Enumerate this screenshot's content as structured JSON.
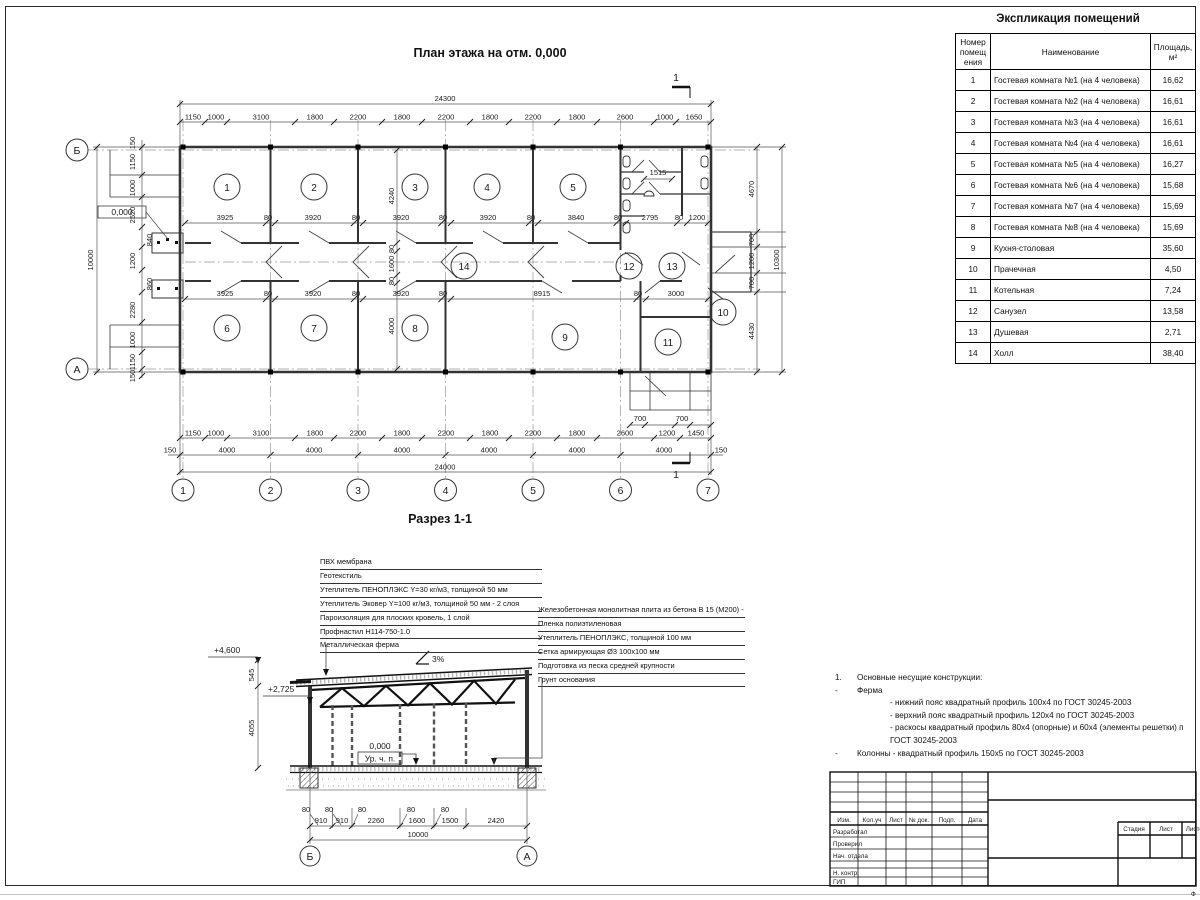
{
  "plan": {
    "title": "План этажа на отм. 0,000",
    "level_mark": "0,000",
    "section_cut_label": "1",
    "dim_total_top": "24300",
    "dims_top": [
      "1150",
      "1000",
      "3100",
      "1800",
      "2200",
      "1800",
      "2200",
      "1800",
      "2200",
      "1800",
      "2600",
      "1000",
      "1650"
    ],
    "dims_row_upper": [
      "3925",
      "80",
      "3920",
      "80",
      "3920",
      "80",
      "3920",
      "80",
      "3840",
      "80",
      "2795",
      "80",
      "1200"
    ],
    "dims_row_lower": [
      "3925",
      "80",
      "3920",
      "80",
      "3920",
      "80",
      "8915",
      "80",
      "3000"
    ],
    "dims_vchain": [
      "4240",
      "80",
      "1600",
      "80",
      "4000"
    ],
    "dim_san": "1515",
    "dims_right": [
      "4670",
      "700",
      "1200",
      "700",
      "4430"
    ],
    "dim_total_right": "10300",
    "dims_left": [
      "150",
      "1150",
      "1000",
      "2520",
      "840",
      "1200",
      "860",
      "2280",
      "1000",
      "1150",
      "150"
    ],
    "dim_total_left": "10000",
    "dims_bottom": [
      "1150",
      "1000",
      "3100",
      "1800",
      "2200",
      "1800",
      "2200",
      "1800",
      "2200",
      "1800",
      "2600",
      "1200",
      "1450"
    ],
    "dims_grid": [
      "150",
      "4000",
      "4000",
      "4000",
      "4000",
      "4000",
      "4000",
      "150"
    ],
    "dim_total_bottom": "24000",
    "dims_porch": [
      "700",
      "700"
    ],
    "grid_cols": [
      "1",
      "2",
      "3",
      "4",
      "5",
      "6",
      "7"
    ],
    "grid_row_top": "Б",
    "grid_row_bottom": "А",
    "rooms": [
      "1",
      "2",
      "3",
      "4",
      "5",
      "6",
      "7",
      "8",
      "9",
      "10",
      "11",
      "12",
      "13",
      "14"
    ]
  },
  "section": {
    "title": "Разрез 1-1",
    "slope_label": "3%",
    "level_top": "+4,600",
    "level_truss": "+2,725",
    "level_floor": "0,000",
    "floor_caption": "Ур. ч. п.",
    "dims_left": [
      "545",
      "4055"
    ],
    "dims_col": [
      "80",
      "80",
      "80",
      "80",
      "80"
    ],
    "dims_bottom": [
      "910",
      "910",
      "2260",
      "1600",
      "1500",
      "2420"
    ],
    "dim_total": "10000",
    "grid_left": "Б",
    "grid_right": "А",
    "roof_layers": [
      "ПВХ мембрана",
      "Геотекстиль",
      "Утеплитель ПЕНОПЛЭКС Y=30 кг/м3, толщиной 50 мм",
      "Утеплитель Эковер Y=100 кг/м3, толщиной 50 мм - 2 слоя",
      "Пароизоляция для плоских кровель, 1 слой",
      "Профнастил Н114-750-1.0",
      "Металлическая ферма"
    ],
    "floor_layers": [
      "Железобетонная монолитная плита из бетона В 15 (М200) - 150 мм",
      "Пленка полиэтиленовая",
      "Утеплитель ПЕНОПЛЭКС, толщиной 100 мм",
      "Сетка армирующая Ø3 100х100 мм",
      "Подготовка из песка средней крупности",
      "Грунт основания"
    ]
  },
  "notes": {
    "items": [
      {
        "m": "1.",
        "t": "Основные несущие конструкции:"
      },
      {
        "m": "-",
        "t": "Ферма"
      },
      {
        "m": "",
        "t": "- нижний пояс квадратный профиль 100х4 по ГОСТ 30245-2003"
      },
      {
        "m": "",
        "t": "- верхний пояс квадратный профиль 120х4 по ГОСТ 30245-2003"
      },
      {
        "m": "",
        "t": "- раскосы квадратный профиль 80х4 (опорные) и 60х4 (элементы решетки) п"
      },
      {
        "m": "",
        "t": "ГОСТ 30245-2003"
      },
      {
        "m": "-",
        "t": "Колонны - квадратный профиль 150х5 по ГОСТ 30245-2003"
      }
    ]
  },
  "schedule": {
    "title": "Экспликация помещений",
    "columns": {
      "num": "Номер помещ ения",
      "name": "Наименование",
      "area": "Площадь, м²"
    },
    "rows": [
      {
        "num": "1",
        "name": "Гостевая комната №1 (на 4 человека)",
        "area": "16,62"
      },
      {
        "num": "2",
        "name": "Гостевая комната №2 (на 4 человека)",
        "area": "16,61"
      },
      {
        "num": "3",
        "name": "Гостевая комната №3 (на 4 человека)",
        "area": "16,61"
      },
      {
        "num": "4",
        "name": "Гостевая комната №4 (на 4 человека)",
        "area": "16,61"
      },
      {
        "num": "5",
        "name": "Гостевая комната №5 (на 4 человека)",
        "area": "16,27"
      },
      {
        "num": "6",
        "name": "Гостевая комната №6 (на 4 человека)",
        "area": "15,68"
      },
      {
        "num": "7",
        "name": "Гостевая комната №7 (на 4 человека)",
        "area": "15,69"
      },
      {
        "num": "8",
        "name": "Гостевая комната №8 (на 4 человека)",
        "area": "15,69"
      },
      {
        "num": "9",
        "name": "Кухня-столовая",
        "area": "35,60"
      },
      {
        "num": "10",
        "name": "Прачечная",
        "area": "4,50"
      },
      {
        "num": "11",
        "name": "Котельная",
        "area": "7,24"
      },
      {
        "num": "12",
        "name": "Санузел",
        "area": "13,58"
      },
      {
        "num": "13",
        "name": "Душевая",
        "area": "2,71"
      },
      {
        "num": "14",
        "name": "Холл",
        "area": "38,40"
      }
    ]
  },
  "titleblock": {
    "cols": [
      "Изм.",
      "Кол.уч",
      "Лист",
      "№ док.",
      "Подп.",
      "Дата"
    ],
    "rows": [
      "Разработал",
      "Проверил",
      "Нач. отдела",
      "Н. контр.",
      "ГИП"
    ],
    "stage": [
      "Стадия",
      "Лист",
      "Листов"
    ],
    "format_note": "Ф"
  }
}
